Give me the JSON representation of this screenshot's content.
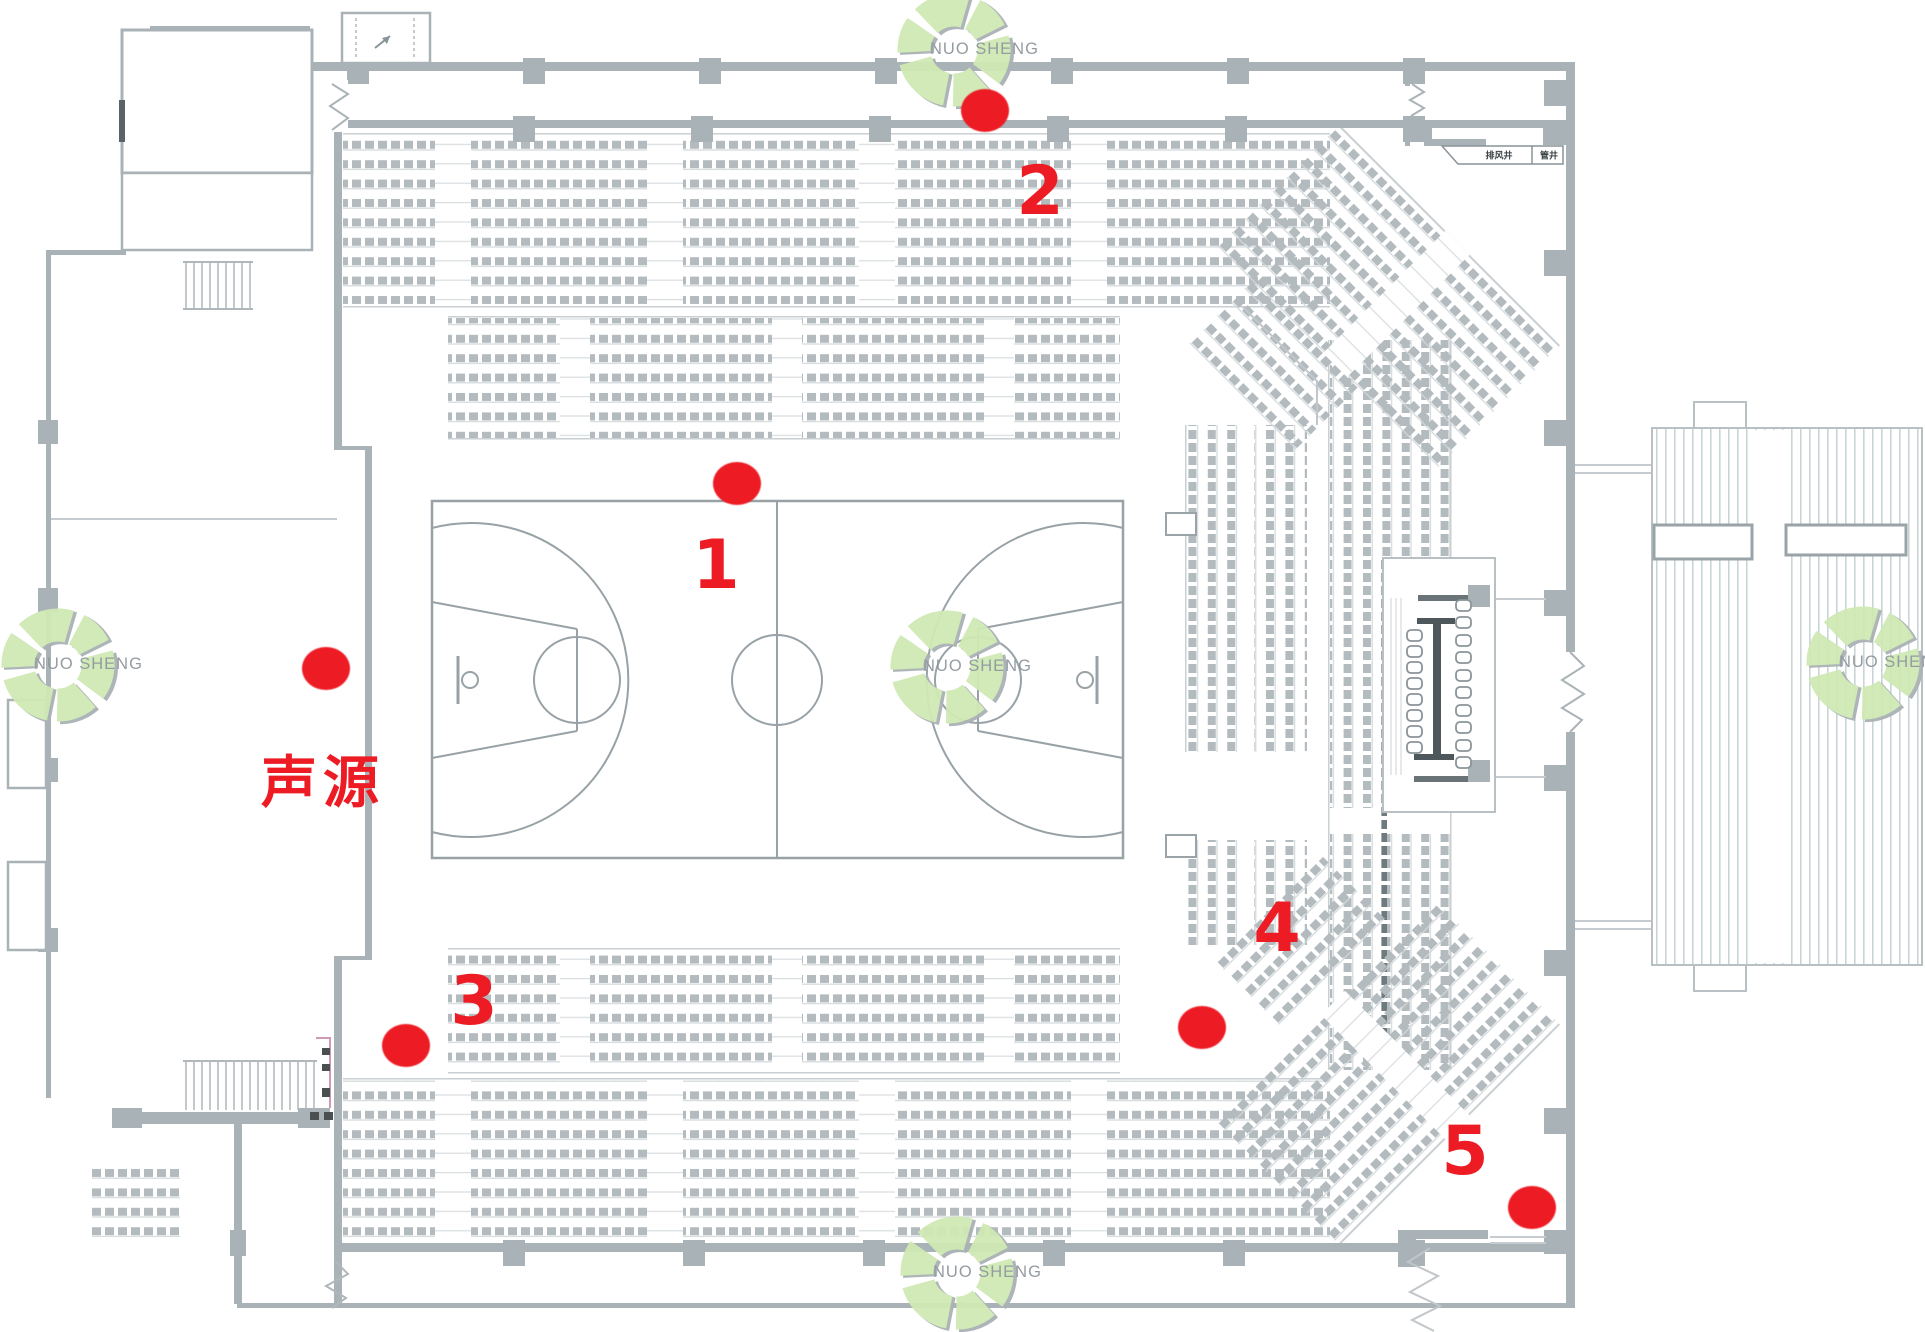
{
  "diagram": {
    "type": "gymnasium-floor-plan-with-acoustic-measurement-points",
    "sound_source": {
      "label": "声源",
      "dot": {
        "x": 326,
        "y": 668
      },
      "label_pos": {
        "x": 323,
        "y": 784
      }
    },
    "measurement_points": [
      {
        "id": "1",
        "dot": {
          "x": 737,
          "y": 483
        },
        "label_pos": {
          "x": 716,
          "y": 566
        }
      },
      {
        "id": "2",
        "dot": {
          "x": 985,
          "y": 110
        },
        "label_pos": {
          "x": 1040,
          "y": 192
        }
      },
      {
        "id": "3",
        "dot": {
          "x": 406,
          "y": 1045
        },
        "label_pos": {
          "x": 474,
          "y": 1002
        }
      },
      {
        "id": "4",
        "dot": {
          "x": 1202,
          "y": 1027
        },
        "label_pos": {
          "x": 1277,
          "y": 929
        }
      },
      {
        "id": "5",
        "dot": {
          "x": 1532,
          "y": 1207
        },
        "label_pos": {
          "x": 1465,
          "y": 1152
        }
      }
    ],
    "room_labels": [
      {
        "text": "排风井",
        "x": 1499,
        "y": 155
      },
      {
        "text": "管井",
        "x": 1549,
        "y": 155
      }
    ]
  },
  "watermark": {
    "text": "NUO SHENG",
    "ring_color": "#cfe9b4",
    "shadow_color": "#aab2b5",
    "text_color": "#8f979c",
    "positions": [
      {
        "x": 954,
        "y": 50
      },
      {
        "x": 58,
        "y": 665
      },
      {
        "x": 947,
        "y": 667
      },
      {
        "x": 1863,
        "y": 663
      },
      {
        "x": 957,
        "y": 1273
      }
    ]
  },
  "colors": {
    "marker_red": "#ed1c24",
    "wall_gray": "#a9b2b6",
    "line_gray": "#98a2a6",
    "seat_gray": "#b3bbbf"
  }
}
